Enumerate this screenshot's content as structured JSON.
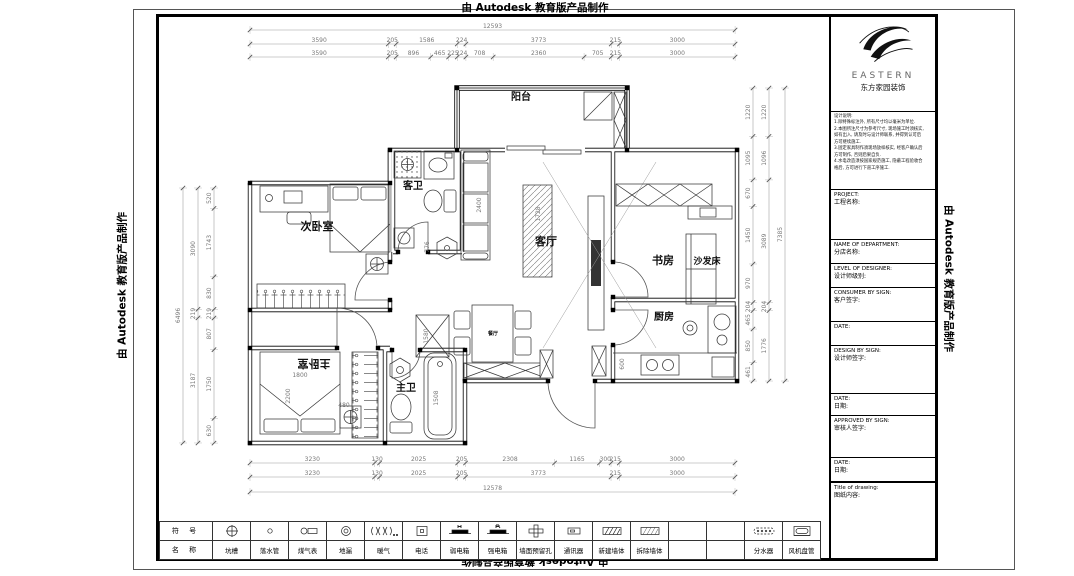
{
  "watermark": "由 Autodesk 教育版产品制作",
  "logo": {
    "name": "EASTERN",
    "subtitle": "东方家园装饰"
  },
  "notes": {
    "title": "设计说明:",
    "lines": [
      "1.除特殊标注外, 所有尺寸均以毫米为单位.",
      "2.本图所注尺寸为参考尺寸, 现场施工时须核实,",
      "如有出入, 请及时与设计师联系, 并得到认可后",
      "方可继续施工.",
      "3.固定家具制作须现场放样核实, 经客户确认后",
      "方可制作, 否则后果自负.",
      "4.水电改造须按国家规范施工, 隐蔽工程验收合",
      "格后, 方可进行下道工序施工."
    ]
  },
  "title_block": {
    "fields": [
      {
        "en": "PROJECT:",
        "cn": "工程名称:",
        "h": 50
      },
      {
        "en": "NAME OF DEPARTMENT:",
        "cn": "分店名称:",
        "h": 24
      },
      {
        "en": "LEVEL OF DESIGNER:",
        "cn": "设计师级别:",
        "h": 24
      },
      {
        "en": "CONSUMER BY SIGN:",
        "cn": "客户签字:",
        "h": 34
      },
      {
        "en": "DATE:",
        "cn": "",
        "h": 24
      },
      {
        "en": "DESIGN BY SIGN:",
        "cn": "设计师签字:",
        "h": 48
      },
      {
        "en": "DATE:",
        "cn": "日期:",
        "h": 22
      },
      {
        "en": "APPROVED BY SIGN:",
        "cn": "审核人签字:",
        "h": 42
      },
      {
        "en": "DATE:",
        "cn": "日期:",
        "h": 24
      },
      {
        "en": "Title of drawing:",
        "cn": "图纸内容:",
        "h": 0
      }
    ]
  },
  "plan": {
    "rooms": [
      {
        "label": "阳台",
        "x": 521,
        "y": 100,
        "size": 10,
        "rot": 0
      },
      {
        "label": "客卫",
        "x": 413,
        "y": 189,
        "size": 10,
        "rot": 0
      },
      {
        "label": "次卧室",
        "x": 317,
        "y": 230,
        "size": 11,
        "rot": 0
      },
      {
        "label": "客厅",
        "x": 546,
        "y": 245,
        "size": 11,
        "rot": 0
      },
      {
        "label": "书房",
        "x": 663,
        "y": 264,
        "size": 11,
        "rot": 0
      },
      {
        "label": "沙发床",
        "x": 707,
        "y": 264,
        "size": 9,
        "rot": 0
      },
      {
        "label": "厨房",
        "x": 664,
        "y": 320,
        "size": 10,
        "rot": 0
      },
      {
        "label": "主卧室",
        "x": 314,
        "y": 360,
        "size": 11,
        "rot": 180
      },
      {
        "label": "主卫",
        "x": 406,
        "y": 391,
        "size": 10,
        "rot": 0
      },
      {
        "label": "餐厅",
        "x": 493,
        "y": 335,
        "size": 5,
        "rot": 0
      }
    ],
    "inline_dims": [
      {
        "text": "2400",
        "x": 481,
        "y": 205,
        "rot": -90
      },
      {
        "text": "776",
        "x": 429,
        "y": 247,
        "rot": -90
      },
      {
        "text": "1728",
        "x": 540,
        "y": 214,
        "rot": -90
      },
      {
        "text": "1580",
        "x": 428,
        "y": 336,
        "rot": -90
      },
      {
        "text": "600",
        "x": 624,
        "y": 364,
        "rot": -90
      },
      {
        "text": "1800",
        "x": 300,
        "y": 377,
        "rot": 0
      },
      {
        "text": "2200",
        "x": 290,
        "y": 396,
        "rot": -90
      },
      {
        "text": "480",
        "x": 344,
        "y": 407,
        "rot": 0
      },
      {
        "text": "1508",
        "x": 438,
        "y": 398,
        "rot": -90
      }
    ],
    "dim_chains": [
      {
        "name": "dim-top-total",
        "o": "h",
        "x0": 250,
        "y": 30,
        "ppm": 0.03852,
        "segs": [
          12593
        ]
      },
      {
        "name": "dim-top-row1",
        "o": "h",
        "x0": 250,
        "y": 44,
        "ppm": 0.03852,
        "segs": [
          3590,
          205,
          1586,
          224,
          3773,
          215,
          3000
        ]
      },
      {
        "name": "dim-top-row2",
        "o": "h",
        "x0": 250,
        "y": 57,
        "ppm": 0.03852,
        "segs": [
          3590,
          205,
          896,
          465,
          225,
          224,
          708,
          2360,
          705,
          215,
          3000
        ]
      },
      {
        "name": "dim-left-outer",
        "o": "v",
        "x": 183,
        "y0": 188,
        "ppm": 0.03925,
        "segs": [
          6496
        ]
      },
      {
        "name": "dim-left-mid",
        "o": "v",
        "x": 198,
        "y0": 188,
        "ppm": 0.03925,
        "segs": [
          3090,
          219,
          3187
        ]
      },
      {
        "name": "dim-left-inner",
        "o": "v",
        "x": 214,
        "y0": 188,
        "ppm": 0.03925,
        "segs": [
          520,
          1743,
          830,
          219,
          807,
          1750,
          630
        ]
      },
      {
        "name": "dim-right-inner",
        "o": "v",
        "x": 753,
        "y0": 88,
        "ppm": 0.03968,
        "segs": [
          1220,
          1095,
          670,
          1450,
          970,
          204,
          465,
          850,
          461
        ]
      },
      {
        "name": "dim-right-mid",
        "o": "v",
        "x": 769,
        "y0": 88,
        "ppm": 0.03968,
        "segs": [
          1220,
          1096,
          3089,
          204,
          1776
        ]
      },
      {
        "name": "dim-right-outer",
        "o": "v",
        "x": 785,
        "y0": 88,
        "ppm": 0.03968,
        "segs": [
          7385
        ]
      },
      {
        "name": "dim-bottom-row1",
        "o": "h",
        "x0": 250,
        "y": 463,
        "ppm": 0.03856,
        "segs": [
          3230,
          130,
          2025,
          205,
          2308,
          1165,
          300,
          215,
          3000
        ]
      },
      {
        "name": "dim-bottom-row2",
        "o": "h",
        "x0": 250,
        "y": 477,
        "ppm": 0.03856,
        "segs": [
          3230,
          130,
          2025,
          205,
          3773,
          215,
          3000
        ]
      },
      {
        "name": "dim-bottom-total",
        "o": "h",
        "x0": 250,
        "y": 492,
        "ppm": 0.03856,
        "segs": [
          12578
        ]
      }
    ]
  },
  "legend": {
    "header_symbol": "符 号",
    "header_name": "名 称",
    "items": [
      {
        "name": "坑槽",
        "icon": "pit"
      },
      {
        "name": "落水管",
        "icon": "downpipe"
      },
      {
        "name": "煤气表",
        "icon": "gas-meter"
      },
      {
        "name": "地漏",
        "icon": "floor-drain"
      },
      {
        "name": "暖气",
        "icon": "radiator"
      },
      {
        "name": "电话",
        "icon": "telephone"
      },
      {
        "name": "弱电箱",
        "icon": "weak-power-box"
      },
      {
        "name": "强电箱",
        "icon": "strong-power-box"
      },
      {
        "name": "墙面预留孔",
        "icon": "wall-hole"
      },
      {
        "name": "通讯器",
        "icon": "intercom"
      },
      {
        "name": "新建墙体",
        "icon": "new-wall"
      },
      {
        "name": "拆除墙体",
        "icon": "demolish-wall"
      },
      {
        "name": "",
        "icon": ""
      },
      {
        "name": "",
        "icon": ""
      },
      {
        "name": "分水器",
        "icon": "water-manifold"
      },
      {
        "name": "风机盘管",
        "icon": "fan-coil"
      }
    ]
  }
}
